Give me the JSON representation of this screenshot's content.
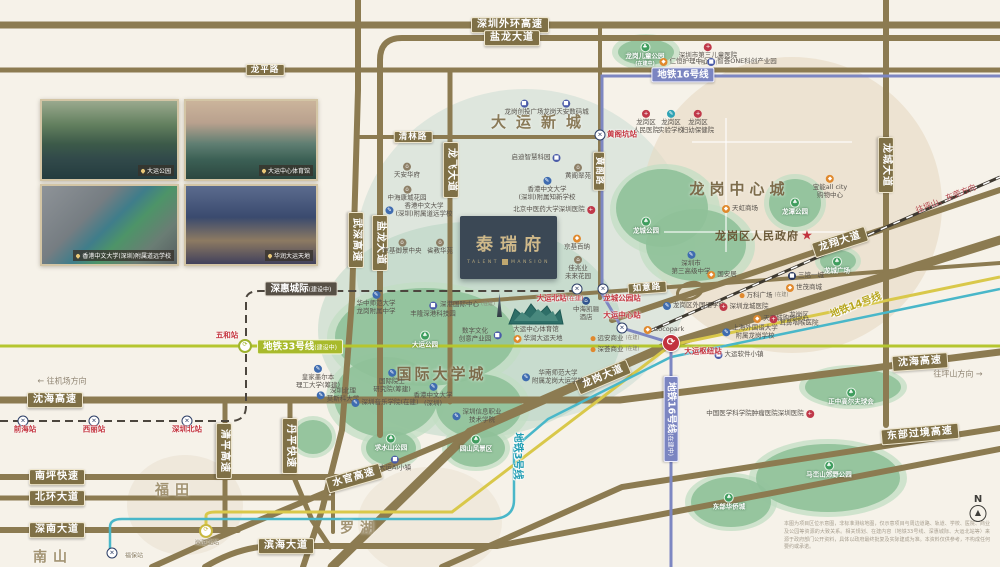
{
  "project": {
    "name_cn": "泰瑞府",
    "name_en1": "TALENT",
    "name_en2": "MANSION"
  },
  "colors": {
    "road": "#8c7b51",
    "metro16": "#7d87c2",
    "metro14": "#d9c84a",
    "metro3": "#49b7c9",
    "metro33": "#b5c62f",
    "rail": "#4c463e",
    "park": "#92c49d",
    "accent_red": "#c4353f"
  },
  "photos": [
    {
      "caption": "大运公园"
    },
    {
      "caption": "大运中心体育馆"
    },
    {
      "caption": "香港中文大学(深圳)附属道远学校"
    },
    {
      "caption": "华润大运天地"
    }
  ],
  "areas": [
    {
      "text": "大运新城",
      "x": 536,
      "y": 123,
      "size": 15,
      "ls": 10,
      "color": "#8a7a58"
    },
    {
      "text": "龙岗中心城",
      "x": 737,
      "y": 190,
      "size": 15,
      "ls": 5,
      "color": "#7d6c4b"
    },
    {
      "text": "国际大学城",
      "x": 440,
      "y": 375,
      "size": 15,
      "ls": 3,
      "color": "#7d6c4b"
    },
    {
      "text": "福田",
      "x": 172,
      "y": 491,
      "size": 14,
      "ls": 6,
      "color": "#a29372"
    },
    {
      "text": "南山",
      "x": 50,
      "y": 558,
      "size": 14,
      "ls": 6,
      "color": "#a29372"
    },
    {
      "text": "罗湖",
      "x": 357,
      "y": 529,
      "size": 14,
      "ls": 6,
      "color": "#a29372"
    }
  ],
  "road_labels": [
    {
      "text": "深圳外环高速",
      "x": 510,
      "y": 25
    },
    {
      "text": "盐龙大道",
      "x": 512,
      "y": 38
    },
    {
      "text": "龙平路",
      "x": 265,
      "y": 70,
      "sm": true
    },
    {
      "text": "清林路",
      "x": 413,
      "y": 137,
      "sm": true
    },
    {
      "text": "武深高速",
      "x": 356,
      "y": 240,
      "rot": 90
    },
    {
      "text": "盐龙大道",
      "x": 380,
      "y": 243,
      "rot": 90
    },
    {
      "text": "龙飞大道",
      "x": 451,
      "y": 170,
      "rot": 90
    },
    {
      "text": "黄阁路",
      "x": 599,
      "y": 171,
      "rot": 90,
      "sm": true
    },
    {
      "text": "如意路",
      "x": 647,
      "y": 288,
      "rot": -4,
      "sm": true
    },
    {
      "text": "龙城大道",
      "x": 886,
      "y": 165,
      "rot": 90
    },
    {
      "text": "龙翔大道",
      "x": 840,
      "y": 242,
      "rot": -18
    },
    {
      "text": "龙岗大道",
      "x": 603,
      "y": 377,
      "rot": -23
    },
    {
      "text": "沈海高速",
      "x": 55,
      "y": 400
    },
    {
      "text": "沈海高速",
      "x": 920,
      "y": 362,
      "rot": -4
    },
    {
      "text": "南坪快速",
      "x": 57,
      "y": 477
    },
    {
      "text": "北环大道",
      "x": 57,
      "y": 498
    },
    {
      "text": "深南大道",
      "x": 57,
      "y": 530
    },
    {
      "text": "滨海大道",
      "x": 286,
      "y": 546
    },
    {
      "text": "水官高速",
      "x": 354,
      "y": 478,
      "rot": -16
    },
    {
      "text": "清平高速",
      "x": 224,
      "y": 451,
      "rot": 90
    },
    {
      "text": "丹平快速",
      "x": 290,
      "y": 446,
      "rot": 90
    },
    {
      "text": "东部过境高速",
      "x": 920,
      "y": 434,
      "rot": -5
    }
  ],
  "metro_labels": [
    {
      "text": "地铁16号线",
      "x": 683,
      "y": 75,
      "cls": "m16badge"
    },
    {
      "text": "地铁16号线",
      "suffix": "(在建中)",
      "x": 671,
      "y": 419,
      "rot": 90,
      "cls": "m16badge"
    },
    {
      "text": "地铁14号线",
      "x": 856,
      "y": 306,
      "rot": -21,
      "cls": "m14text"
    },
    {
      "text": "地铁3号线",
      "x": 517,
      "y": 456,
      "rot": 90,
      "cls": "m3text"
    },
    {
      "text": "地铁33号线",
      "suffix": "(建设中)",
      "x": 300,
      "y": 347,
      "cls": "m33badge"
    },
    {
      "text": "深惠城际",
      "suffix": "(建设中)",
      "x": 301,
      "y": 289,
      "cls": "railbadge"
    }
  ],
  "stations": [
    {
      "label": "黄阁坑站",
      "lx": 622,
      "ly": 135,
      "mark": "x",
      "mx": 600,
      "my": 135
    },
    {
      "label": "大运北站",
      "suffix": "(在建)",
      "lx": 560,
      "ly": 299,
      "mark": "x",
      "mx": 577,
      "my": 289
    },
    {
      "label": "龙城公园站",
      "lx": 622,
      "ly": 299,
      "mark": "x",
      "mx": 603,
      "my": 289
    },
    {
      "label": "大运中心站",
      "lx": 622,
      "ly": 316,
      "mark": "x",
      "mx": 622,
      "my": 328
    },
    {
      "label": "大运枢纽站",
      "lx": 703,
      "ly": 352,
      "mark": "hub",
      "mx": 671,
      "my": 343
    },
    {
      "label": "五和站",
      "lx": 227,
      "ly": 336,
      "mark": "ring",
      "ring": "#9fb32e",
      "mx": 245,
      "my": 346
    },
    {
      "label": "岗厦北站",
      "small": true,
      "lx": 207,
      "ly": 543,
      "mark": "ring",
      "ring": "#c9b83e",
      "mx": 206,
      "my": 531
    },
    {
      "label": "前海站",
      "lx": 25,
      "ly": 430,
      "mark": "x",
      "mx": 23,
      "my": 421
    },
    {
      "label": "西丽站",
      "lx": 94,
      "ly": 430,
      "mark": "x",
      "mx": 94,
      "my": 421
    },
    {
      "label": "深圳北站",
      "lx": 187,
      "ly": 430,
      "mark": "x",
      "mx": 187,
      "my": 421
    },
    {
      "label": "福保站",
      "small": true,
      "lx": 134,
      "ly": 556,
      "mark": "x",
      "mx": 112,
      "my": 553
    }
  ],
  "directions": [
    {
      "text": "← 往机场方向",
      "x": 62,
      "y": 381
    },
    {
      "text": "往坪山方向 →",
      "x": 958,
      "y": 374
    },
    {
      "text": "往坪山、东莞方向",
      "x": 946,
      "y": 199,
      "rot": -22,
      "color": "#b5454d"
    }
  ],
  "parks": [
    {
      "text": "龙岗儿童公园",
      "suffix": "(在建中)",
      "x": 645,
      "y": 55
    },
    {
      "text": "龙城公园",
      "x": 646,
      "y": 226
    },
    {
      "text": "龙潭公园",
      "x": 795,
      "y": 207
    },
    {
      "text": "龙城广场",
      "x": 837,
      "y": 266
    },
    {
      "text": "大运公园",
      "x": 425,
      "y": 340
    },
    {
      "text": "求水山公园",
      "x": 391,
      "y": 443
    },
    {
      "text": "园山风景区",
      "x": 476,
      "y": 444
    },
    {
      "text": "正中高尔夫球会",
      "x": 851,
      "y": 397
    },
    {
      "text": "马峦山郊野公园",
      "x": 829,
      "y": 470
    },
    {
      "text": "东部华侨城",
      "x": 729,
      "y": 502
    }
  ],
  "pois": [
    {
      "icon": "hospital-icon",
      "ip": "top",
      "text": "深圳市第三儿童医院",
      "suffix": "(在建中)",
      "x": 708,
      "y": 55
    },
    {
      "icon": "shop-icon",
      "ip": "left",
      "text": "仁恒护理中心",
      "x": 684,
      "y": 62
    },
    {
      "icon": "biz-icon",
      "ip": "left",
      "text": "智荟ONE科创产业园",
      "x": 742,
      "y": 62
    },
    {
      "icon": "biz-icon",
      "ip": "top",
      "text": "龙岗创投广场",
      "x": 524,
      "y": 108
    },
    {
      "icon": "biz-icon",
      "ip": "top",
      "text": "龙岗天安数码城",
      "x": 566,
      "y": 108
    },
    {
      "icon": "hospital-icon",
      "ip": "top",
      "text": "龙岗区\n人民医院",
      "x": 646,
      "y": 122
    },
    {
      "icon": "teal-school-icon",
      "ip": "top",
      "text": "龙岗区\n实验学校",
      "x": 671,
      "y": 122
    },
    {
      "icon": "hospital-icon",
      "ip": "top",
      "text": "龙岗区\n妇幼保健院",
      "x": 698,
      "y": 122
    },
    {
      "icon": "shop-icon",
      "ip": "top",
      "text": "宝能all city\n购物中心",
      "x": 830,
      "y": 187
    },
    {
      "icon": "shop-icon",
      "ip": "left",
      "text": "天虹商场",
      "x": 740,
      "y": 209
    },
    {
      "icon": "home-icon",
      "ip": "top",
      "text": "天安华府",
      "x": 407,
      "y": 171
    },
    {
      "icon": "home-icon",
      "ip": "top",
      "text": "中海康城花园",
      "x": 407,
      "y": 194
    },
    {
      "icon": "school-icon",
      "ip": "left",
      "text": "香港中文大学\n(深圳)附属道远学校",
      "x": 419,
      "y": 210
    },
    {
      "icon": "home-icon",
      "ip": "top",
      "text": "京基御景中央",
      "x": 402,
      "y": 247
    },
    {
      "icon": "home-icon",
      "ip": "top",
      "text": "省教华苑",
      "x": 440,
      "y": 247
    },
    {
      "icon": "biz-icon",
      "ip": "right",
      "text": "启迪智慧科园",
      "x": 536,
      "y": 158
    },
    {
      "icon": "home-icon",
      "ip": "top",
      "text": "黄阁翠苑",
      "x": 578,
      "y": 172
    },
    {
      "icon": "school-icon",
      "ip": "top",
      "text": "香港中文大学\n(深圳)附属知新学校",
      "x": 547,
      "y": 189
    },
    {
      "icon": "hospital-icon",
      "ip": "right",
      "text": "北京中医药大学深圳医院",
      "x": 554,
      "y": 210
    },
    {
      "icon": "shop-icon",
      "ip": "top",
      "text": "京基百纳",
      "x": 577,
      "y": 243
    },
    {
      "icon": "home-icon",
      "ip": "top",
      "text": "佳兆业\n未来花园",
      "x": 578,
      "y": 268
    },
    {
      "icon": "school-icon",
      "ip": "top",
      "text": "华中师范大学\n龙岗附属中学",
      "x": 376,
      "y": 303
    },
    {
      "icon": "biz-icon",
      "ip": "top",
      "text": "丰隆深港科技园",
      "x": 433,
      "y": 310
    },
    {
      "icon": "tower-icon",
      "ip": "right",
      "text": "深港国际中心",
      "suffix": "(在建)",
      "x": 471,
      "y": 305
    },
    {
      "icon": "biz-icon",
      "ip": "right",
      "text": "数字文化\n创意产业园",
      "x": 480,
      "y": 335
    },
    {
      "icon": "none",
      "ip": "none",
      "text": "大运中心体育馆",
      "x": 536,
      "y": 330
    },
    {
      "icon": "shop-icon",
      "ip": "left",
      "text": "华润大运天地",
      "x": 538,
      "y": 339
    },
    {
      "icon": "school-icon",
      "ip": "top",
      "text": "香港中文大学\n(深圳)",
      "x": 433,
      "y": 395
    },
    {
      "icon": "school-icon",
      "ip": "left",
      "text": "华南师范大学\n附属龙岗大运学校",
      "x": 553,
      "y": 377
    },
    {
      "icon": "school-icon",
      "ip": "left",
      "text": "深圳信息职业\n技术学院",
      "x": 477,
      "y": 416
    },
    {
      "icon": "school-icon",
      "ip": "top",
      "text": "皇家墨尔本\n理工大学(筹建)",
      "x": 318,
      "y": 377
    },
    {
      "icon": "school-icon",
      "ip": "top",
      "text": "国际院士\n研究院(筹建)",
      "x": 392,
      "y": 381
    },
    {
      "icon": "school-icon",
      "ip": "left",
      "text": "深圳北理\n莫斯科大学",
      "x": 338,
      "y": 395
    },
    {
      "icon": "school-icon",
      "ip": "left",
      "text": "深圳音乐学院(在建)",
      "x": 385,
      "y": 403
    },
    {
      "icon": "biz-icon",
      "ip": "top",
      "text": "大运AI小镇",
      "x": 395,
      "y": 464
    },
    {
      "icon": "school-icon",
      "ip": "top",
      "text": "深圳市\n第三高级中学",
      "x": 691,
      "y": 263
    },
    {
      "icon": "school-icon",
      "ip": "left",
      "text": "龙岗区外国语学校",
      "x": 694,
      "y": 306
    },
    {
      "icon": "hotel-icon",
      "ip": "top",
      "text": "中海凯骊\n酒店",
      "x": 586,
      "y": 309
    },
    {
      "icon": "shop-icon",
      "ip": "left",
      "text": "Cocopark",
      "x": 664,
      "y": 330
    },
    {
      "icon": "dot-icon",
      "ip": "left",
      "text": "远安商业",
      "suffix": "(在建)",
      "x": 615,
      "y": 339
    },
    {
      "icon": "dot-icon",
      "ip": "left",
      "text": "深荟商业",
      "suffix": "(在建)",
      "x": 615,
      "y": 350
    },
    {
      "icon": "shop-icon",
      "ip": "left",
      "text": "天天城购物中心",
      "x": 781,
      "y": 319
    },
    {
      "icon": "biz-icon",
      "ip": "left",
      "text": "大运软件小镇",
      "x": 739,
      "y": 355
    },
    {
      "icon": "school-icon",
      "ip": "left",
      "text": "上海外国语大学\n附属龙岗学校",
      "x": 750,
      "y": 332
    },
    {
      "icon": "hospital-icon",
      "ip": "left",
      "text": "深圳龙城医院",
      "x": 744,
      "y": 307
    },
    {
      "icon": "hospital-icon",
      "ip": "left",
      "text": "龙岗区\n耳鼻咽喉医院",
      "x": 794,
      "y": 319
    },
    {
      "icon": "dot-icon",
      "ip": "left",
      "text": "万科广场",
      "suffix": "(在建)",
      "x": 764,
      "y": 296
    },
    {
      "icon": "shop-icon",
      "ip": "left",
      "text": "世茂商城",
      "x": 804,
      "y": 288
    },
    {
      "icon": "navy-icon",
      "ip": "left",
      "text": "三馆一城",
      "x": 806,
      "y": 276
    },
    {
      "icon": "shop-icon",
      "ip": "left",
      "text": "国安居",
      "x": 722,
      "y": 275
    },
    {
      "icon": "hospital-icon",
      "ip": "right",
      "text": "中国医学科学院肿瘤医院深圳医院",
      "x": 760,
      "y": 414
    },
    {
      "icon": "star-icon",
      "ip": "right",
      "text": "龙岗区人民政府",
      "x": 764,
      "y": 237,
      "gov": true
    }
  ],
  "compass": {
    "label": "N"
  },
  "disclaimer": "本图为项目区位示意图，非标准测绘地图，仅示意项目与周边道路、轨道、学校、医院、商业及公园等资源的大致关系。相关规划、在建内容（地铁33号线、深惠城际、大运北站等）来源于政府部门公开资料，具体以政府最终批复及实际建成为准。本资料仅供参考，不构成任何要约或承诺。"
}
